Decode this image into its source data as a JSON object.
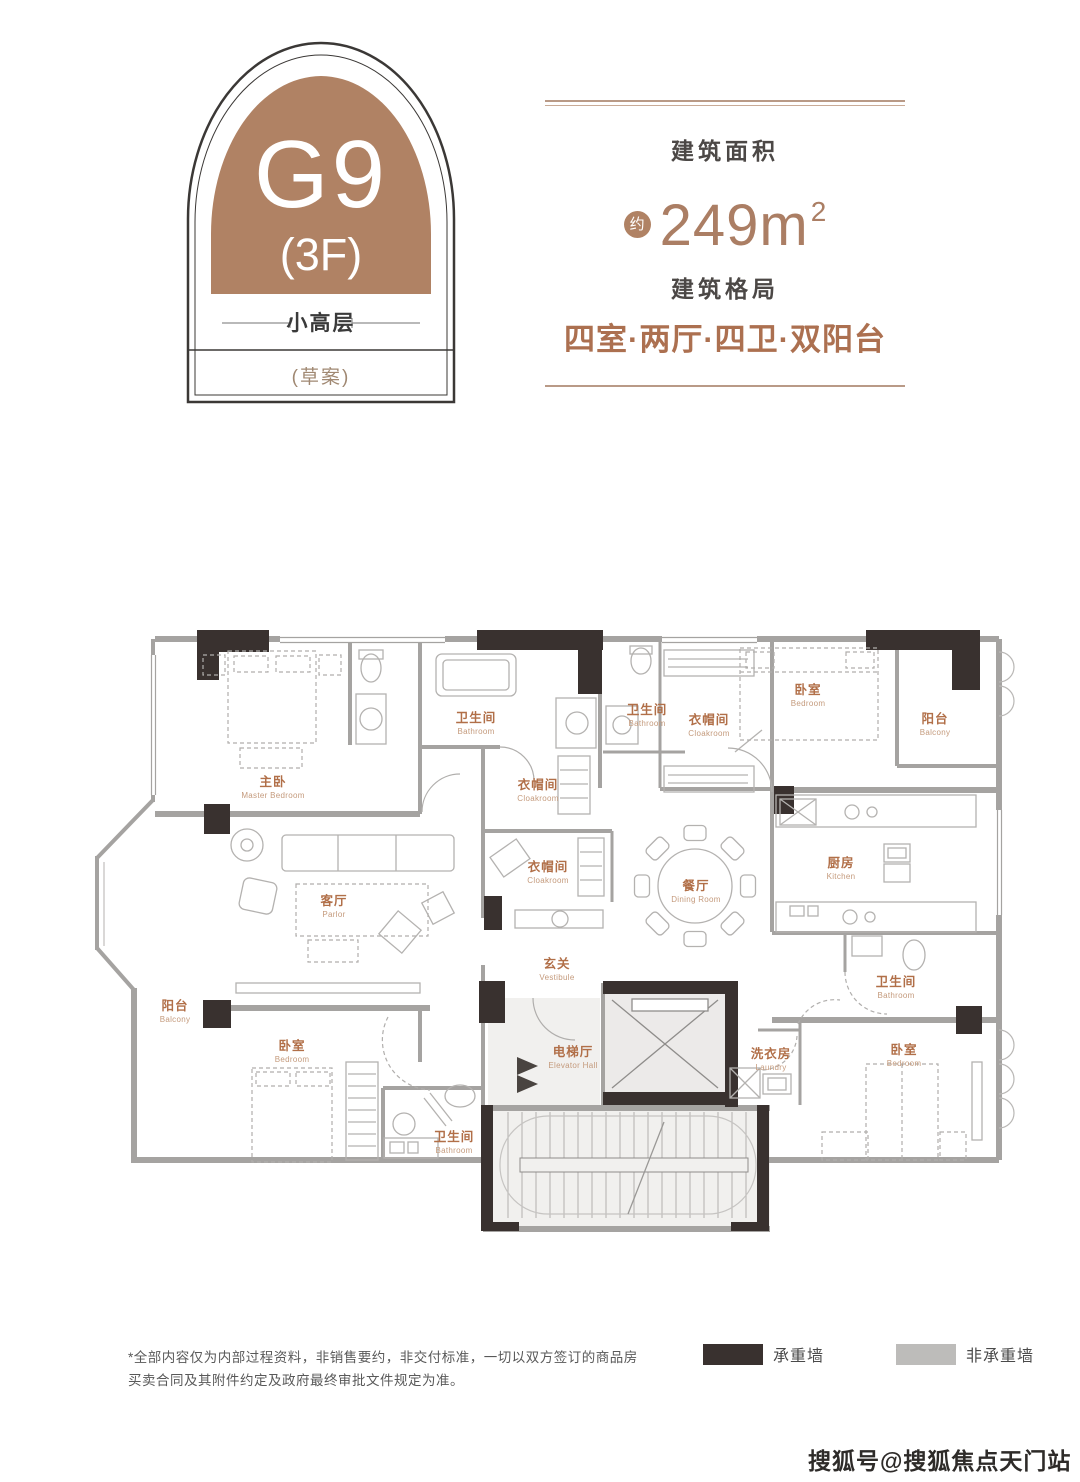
{
  "badge": {
    "unit": "G9",
    "floor": "(3F)",
    "type": "小高层",
    "note": "(草案)"
  },
  "info": {
    "area_label": "建筑面积",
    "area_approx": "约",
    "area_value": "249m",
    "area_sup": "2",
    "layout_label": "建筑格局",
    "layout_value": "四室·两厅·四卫·双阳台"
  },
  "floorplan": {
    "rooms": [
      {
        "zh": "主卧",
        "en": "Master Bedroom"
      },
      {
        "zh": "卫生间",
        "en": "Bathroom"
      },
      {
        "zh": "衣帽间",
        "en": "Cloakroom"
      },
      {
        "zh": "卫生间",
        "en": "Bathroom"
      },
      {
        "zh": "衣帽间",
        "en": "Cloakroom"
      },
      {
        "zh": "卧室",
        "en": "Bedroom"
      },
      {
        "zh": "阳台",
        "en": "Balcony"
      },
      {
        "zh": "厨房",
        "en": "Kitchen"
      },
      {
        "zh": "餐厅",
        "en": "Dining Room"
      },
      {
        "zh": "衣帽间",
        "en": "Cloakroom"
      },
      {
        "zh": "客厅",
        "en": "Parlor"
      },
      {
        "zh": "玄关",
        "en": "Vestibule"
      },
      {
        "zh": "阳台",
        "en": "Balcony"
      },
      {
        "zh": "卧室",
        "en": "Bedroom"
      },
      {
        "zh": "电梯厅",
        "en": "Elevator Hall"
      },
      {
        "zh": "洗衣房",
        "en": "Laundry"
      },
      {
        "zh": "卫生间",
        "en": "Bathroom"
      },
      {
        "zh": "卧室",
        "en": "Bedroom"
      },
      {
        "zh": "卫生间",
        "en": "Bathroom"
      }
    ]
  },
  "legend": {
    "bearing": "承重墙",
    "non_bearing": "非承重墙"
  },
  "disclaimer": "*全部内容仅为内部过程资料，非销售要约，非交付标准，一切以双方签订的商品房买卖合同及其附件约定及政府最终审批文件规定为准。",
  "watermark": "搜狐号@搜狐焦点天门站",
  "colors": {
    "badge_brown": "#b08264",
    "label_brown": "#b16f48",
    "accent_text": "#ab7e64",
    "header_line": "#b99a87",
    "wall_dark": "#39312f",
    "wall_gray": "#a5a3a1",
    "legend_gray": "#bdbcba",
    "text_dark": "#4c4846"
  }
}
